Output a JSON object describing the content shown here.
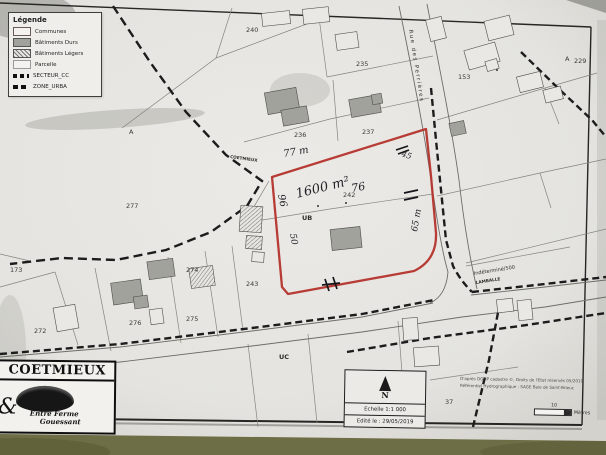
{
  "legend": {
    "title": "Légende",
    "items": [
      {
        "label": "Communes",
        "swatch": "communes"
      },
      {
        "label": "Bâtiments Durs",
        "swatch": "durs"
      },
      {
        "label": "Bâtiments Légers",
        "swatch": "legers"
      },
      {
        "label": "Parcelle",
        "swatch": "parcelle"
      },
      {
        "label": "SECTEUR_CC",
        "swatch": "secteur"
      },
      {
        "label": "ZONE_URBA",
        "swatch": "urba"
      }
    ]
  },
  "banner": {
    "title": "COETMIEUX",
    "ampersand": "&",
    "logo_line1": "Entre Ferme",
    "logo_line2": "Gouessant"
  },
  "scalebox": {
    "north": "N",
    "scale": "Echelle 1:1 000",
    "edited": "Edité le : 29/05/2019"
  },
  "credits": {
    "line1": "D'après DGFiP cadastre ©, Droits de l'Etat réservés 05/2019",
    "line2": "Référentiel Hydrographique : SAGE Baie de Saint-Brieuc",
    "distance": "10",
    "unit": "Mètres"
  },
  "roads": {
    "main": "Rue des Perrières",
    "secondary": "Indéterminé/500",
    "direction": "LAMBALLE"
  },
  "commune_boundary_label": "COETMIEUX",
  "parcel_labels": [
    {
      "text": "240",
      "x": 246,
      "y": 32
    },
    {
      "text": "235",
      "x": 356,
      "y": 66
    },
    {
      "text": "236",
      "x": 294,
      "y": 137
    },
    {
      "text": "237",
      "x": 362,
      "y": 134
    },
    {
      "text": "153",
      "x": 458,
      "y": 79
    },
    {
      "text": "A",
      "x": 565,
      "y": 61,
      "s": 5
    },
    {
      "text": "229",
      "x": 574,
      "y": 63
    },
    {
      "text": "A",
      "x": 129,
      "y": 134,
      "s": 5
    },
    {
      "text": "277",
      "x": 126,
      "y": 208
    },
    {
      "text": "173",
      "x": 10,
      "y": 272
    },
    {
      "text": "272",
      "x": 34,
      "y": 333
    },
    {
      "text": "276",
      "x": 129,
      "y": 325
    },
    {
      "text": "275",
      "x": 186,
      "y": 321
    },
    {
      "text": "274",
      "x": 186,
      "y": 272
    },
    {
      "text": "243",
      "x": 246,
      "y": 286
    },
    {
      "text": "242",
      "x": 343,
      "y": 197,
      "s": 5
    },
    {
      "text": "37",
      "x": 445,
      "y": 404
    },
    {
      "text": "UB",
      "x": 302,
      "y": 220,
      "s": 5.5,
      "bold": true
    },
    {
      "text": "UC",
      "x": 279,
      "y": 359,
      "s": 5.5,
      "bold": true
    }
  ],
  "handwriting": [
    {
      "text": "77 m",
      "x": 284,
      "y": 157,
      "rot": -10,
      "s": 10
    },
    {
      "text": "1600 m²",
      "x": 297,
      "y": 198,
      "rot": -14,
      "s": 13
    },
    {
      "text": "76",
      "x": 352,
      "y": 192,
      "rot": -10,
      "s": 11
    },
    {
      "text": "96",
      "x": 278,
      "y": 195,
      "rot": 78,
      "s": 10
    },
    {
      "text": "50",
      "x": 290,
      "y": 234,
      "rot": 80,
      "s": 9
    },
    {
      "text": "65 m",
      "x": 417,
      "y": 232,
      "rot": -80,
      "s": 9
    },
    {
      "text": "45",
      "x": 401,
      "y": 156,
      "rot": 18,
      "s": 8
    }
  ],
  "colors": {
    "outline_red": "#b5332c",
    "building_gray": "#a2a29c",
    "paper": "#e8e7e3",
    "table_green": "#6d6e45"
  }
}
